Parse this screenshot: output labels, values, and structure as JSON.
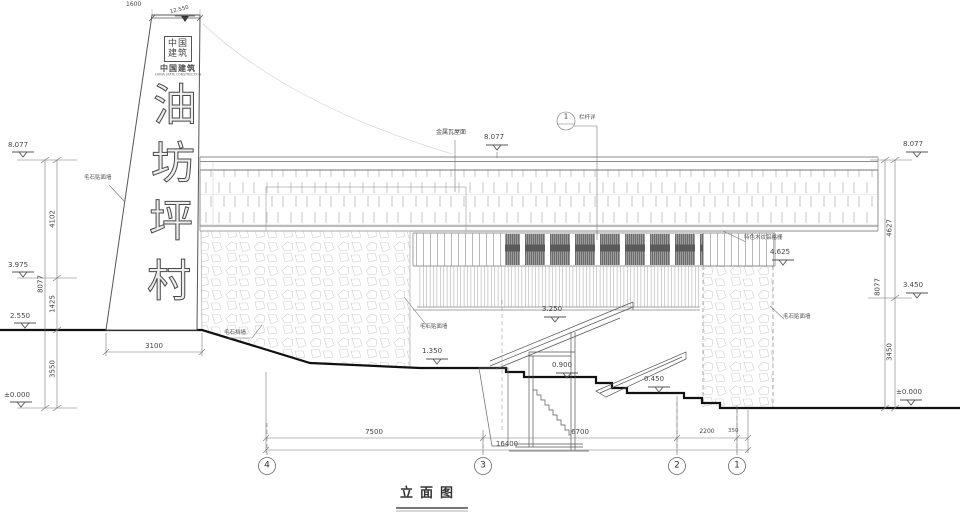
{
  "title": "立面图",
  "sign": {
    "width_dim": "1600",
    "top_elevation": "12.550",
    "logo_seal": "中国建筑",
    "logo_cn": "中国建筑",
    "logo_en": "CHINA STATE CONSTRUCTION",
    "name_chars": [
      "油",
      "坊",
      "坪",
      "村"
    ],
    "base_dim": "3100"
  },
  "left_dims": {
    "elev_top": "8.077",
    "seg_top": "4102",
    "total": "8077",
    "elev_mid": "3.975",
    "seg_mid": "1425",
    "elev_ground": "2.550",
    "seg_bottom": "3550",
    "elev_zero": "±0.000"
  },
  "right_dims": {
    "elev_top": "8.077",
    "seg_top": "4627",
    "total": "8077",
    "elev_mid": "3.450",
    "seg_bottom": "3450",
    "elev_zero": "±0.000"
  },
  "annotations": {
    "roof_label": "金属瓦屋面",
    "roof_elev": "8.077",
    "callout_num": "1",
    "callout_label": "栏杆详",
    "grille_label": "特色木纹铝格栅",
    "grille_elev": "4.625",
    "landing_elev": "3.250",
    "stone_left": "毛石贴面墙",
    "stone_retain": "毛石挡墙",
    "stone_mid": "毛石贴面墙",
    "stone_right": "毛石贴面墙",
    "level_1350": "1.350",
    "level_0900": "0.900",
    "level_0450": "0.450"
  },
  "bottom_dims": {
    "d_43": "7500",
    "d_32": "6700",
    "d_21": "2200",
    "d_end": "350",
    "total": "16400"
  },
  "grid": {
    "g4": "4",
    "g3": "3",
    "g2": "2",
    "g1": "1"
  },
  "colors": {
    "line": "#555555",
    "ground": "#111111",
    "panel_dark": "#3d3d3d",
    "stone_outline": "#cfcfcf"
  }
}
